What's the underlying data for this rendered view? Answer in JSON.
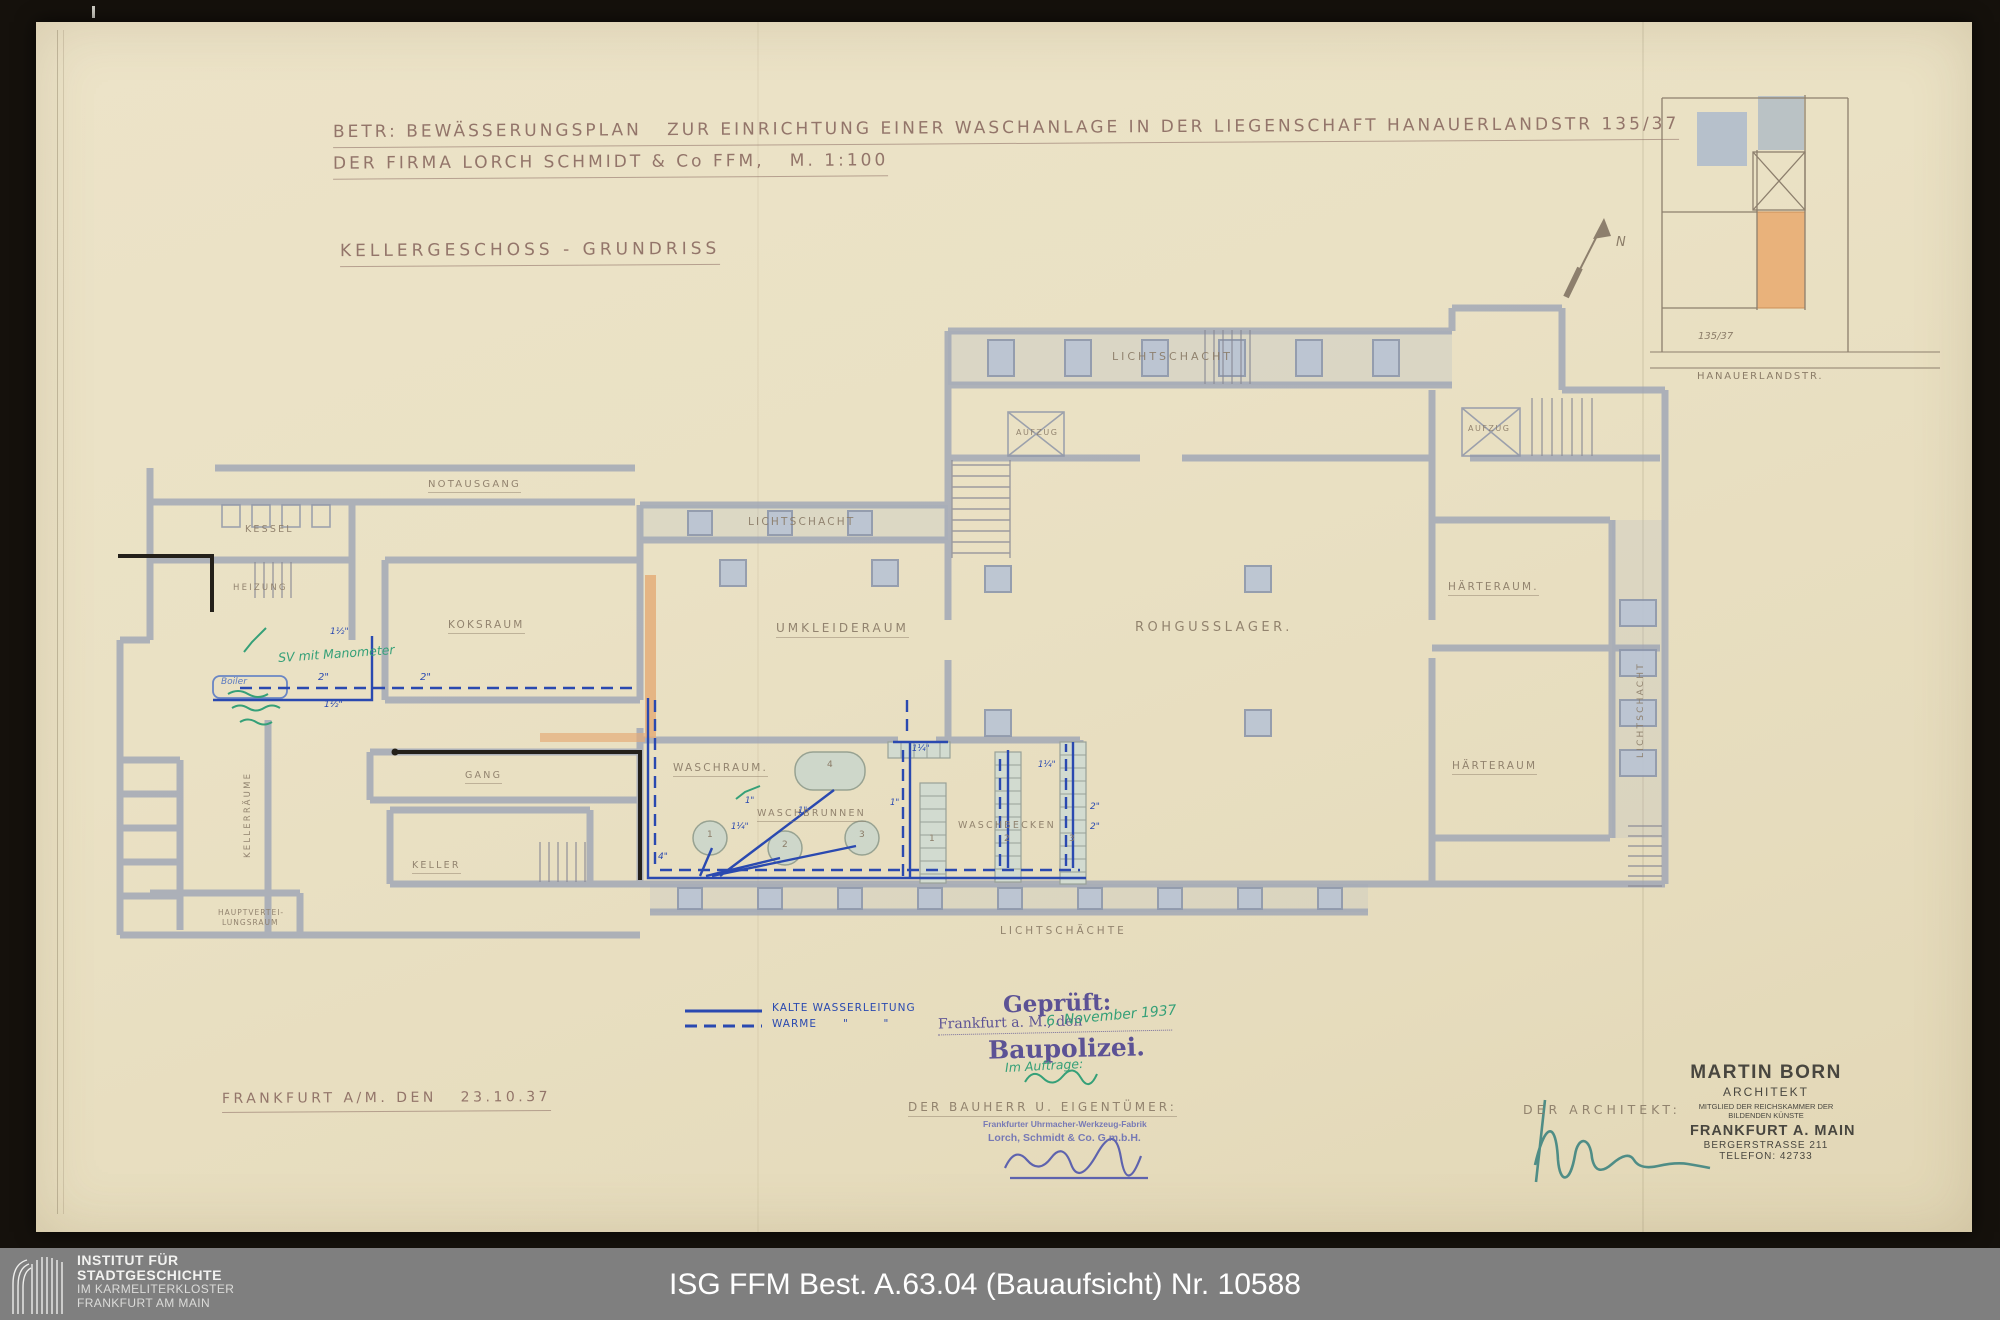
{
  "document": {
    "subject_line1": "BETR: BEWÄSSERUNGSPLAN   ZUR EINRICHTUNG EINER WASCHANLAGE IN DER LIEGENSCHAFT HANAUERLANDSTR 135/37",
    "subject_line2": "DER FIRMA LORCH SCHMIDT & Co FFM,   M. 1:100",
    "drawing_title": "KELLERGESCHOSS - GRUNDRISS",
    "place_date": "FRANKFURT A/M. DEN   23.10.37"
  },
  "inset": {
    "parcel_number": "135/37",
    "street_name": "HANAUERLANDSTR.",
    "north_letter": "N"
  },
  "rooms": [
    {
      "id": "notausgang",
      "label": "NOTAUSGANG"
    },
    {
      "id": "kessel",
      "label": "KESSEL"
    },
    {
      "id": "heizung",
      "label": "HEIZUNG"
    },
    {
      "id": "koksraum",
      "label": "KOKSRAUM"
    },
    {
      "id": "lichtschacht-mitte",
      "label": "LICHTSCHACHT"
    },
    {
      "id": "umkleideraum",
      "label": "UMKLEIDERAUM"
    },
    {
      "id": "rohgusslager",
      "label": "ROHGUSSLAGER."
    },
    {
      "id": "lichtschacht-oben",
      "label": "LICHTSCHACHT"
    },
    {
      "id": "aufzug-links",
      "label": "AUFZUG"
    },
    {
      "id": "aufzug-rechts",
      "label": "AUFZUG"
    },
    {
      "id": "haerteraum-oben",
      "label": "HÄRTERAUM."
    },
    {
      "id": "haerteraum-unten",
      "label": "HÄRTERAUM"
    },
    {
      "id": "lichtschacht-rechts",
      "label": "LICHTSCHACHT"
    },
    {
      "id": "waschraum",
      "label": "WASCHRAUM."
    },
    {
      "id": "waschbrunnen",
      "label": "WASCHBRUNNEN"
    },
    {
      "id": "waschbecken",
      "label": "WASCHBECKEN"
    },
    {
      "id": "gang",
      "label": "GANG"
    },
    {
      "id": "keller",
      "label": "KELLER"
    },
    {
      "id": "kellerraeume",
      "label": "KELLERRÄUME"
    },
    {
      "id": "hauptverteilung-1",
      "label": "HAUPTVERTEI-"
    },
    {
      "id": "hauptverteilung-2",
      "label": "LUNGSRAUM"
    },
    {
      "id": "lichtschaechte",
      "label": "LICHTSCHÄCHTE"
    }
  ],
  "fixtures": {
    "brunnen_numbers": [
      "1",
      "2",
      "3",
      "4"
    ],
    "becken_numbers": [
      "1",
      "2",
      "3"
    ]
  },
  "pipe_labels": [
    {
      "id": "p0",
      "text": "2\""
    },
    {
      "id": "p1",
      "text": "2\""
    },
    {
      "id": "p2",
      "text": "1½\""
    },
    {
      "id": "p3",
      "text": "1½\""
    },
    {
      "id": "p4",
      "text": "1¼\""
    },
    {
      "id": "p5",
      "text": "1\""
    },
    {
      "id": "p6",
      "text": "1\""
    },
    {
      "id": "p7",
      "text": "1¼\""
    },
    {
      "id": "p8",
      "text": "4\""
    },
    {
      "id": "p9",
      "text": "2\""
    },
    {
      "id": "p10",
      "text": "2\""
    },
    {
      "id": "p11",
      "text": "1¼\""
    },
    {
      "id": "p12",
      "text": "1\""
    }
  ],
  "legend": {
    "cold_label": "KALTE WASSERLEITUNG",
    "warm_label": "WARME      \"        \""
  },
  "notes": {
    "sv_note": "SV mit Manometer",
    "boiler_label": "Boiler"
  },
  "stamps": {
    "gepruft_title": "Geprüft:",
    "gepruft_place": "Frankfurt a. M., den",
    "gepruft_date_hand": "6. November 1937",
    "gepruft_authority": "Baupolizei.",
    "im_auftrage": "Im Auftrage:",
    "bauherr_heading": "DER BAUHERR U. EIGENTÜMER:",
    "firm_line1": "Frankfurter Uhrmacher-Werkzeug-Fabrik",
    "firm_line2": "Lorch, Schmidt & Co. G.m.b.H.",
    "architekt_heading": "DER ARCHITEKT:",
    "architect_stamp": {
      "name": "MARTIN BORN",
      "role": "ARCHITEKT",
      "member_line1": "MITGLIED DER REICHSKAMMER DER",
      "member_line2": "BILDENDEN KÜNSTE",
      "city": "FRANKFURT A. MAIN",
      "street": "BERGERSTRASSE 211",
      "phone": "TELEFON: 42733"
    }
  },
  "footer": {
    "institute_bold1": "INSTITUT FÜR",
    "institute_bold2": "STADTGESCHICHTE",
    "institute_sub1": "IM KARMELITERKLOSTER",
    "institute_sub2": "FRANKFURT AM MAIN",
    "archive_reference": "ISG FFM Best. A.63.04 (Bauaufsicht) Nr. 10588"
  },
  "colors": {
    "paper": "#eae1c4",
    "ink_blue": "#2a49b0",
    "ink_green": "#35a078",
    "stamp_purple": "#4a4090",
    "stamp_violet": "#6b6fb5",
    "wall_gray": "#9ba3b5",
    "footer_gray": "#7f7f7f"
  }
}
